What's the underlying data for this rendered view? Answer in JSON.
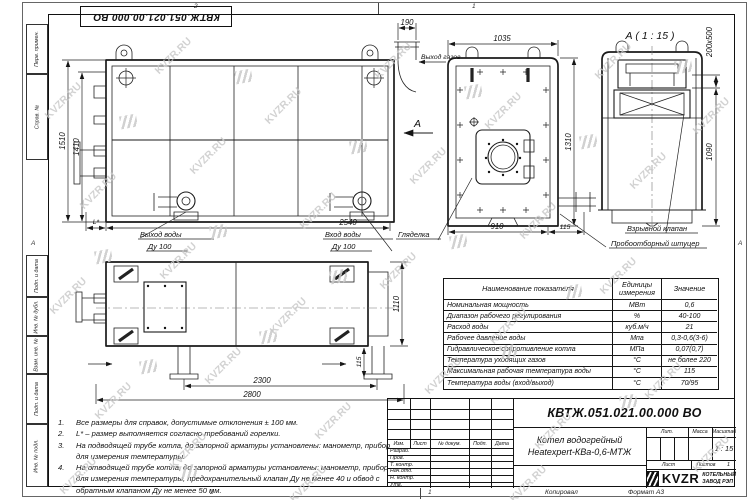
{
  "watermark": {
    "text": "KVZR.RU"
  },
  "frame": {
    "stamp": "КВТЖ.051.021.00.000 ВО",
    "left_labels": [
      "Перв. примен.",
      "Справ. №",
      "Подп. и дата",
      "Инв. № дубл.",
      "Взам. инв. №",
      "Подп. и дата",
      "Инв. № подл."
    ],
    "zone_top_left": "2",
    "zone_top_right": "1",
    "zone_bottom_left": "2",
    "zone_bottom_right": "1",
    "zone_side": "А",
    "copied": "Копировал",
    "format": "Формат А3"
  },
  "front_view": {
    "dim_height_outer": "1510",
    "dim_height_inner": "1410",
    "dim_width": "2540",
    "dim_gas": "190",
    "dim_l": "L*",
    "label_gas_out": "Выход газов",
    "label_water_out_1": "Выход воды",
    "label_water_out_2": "Ду 100",
    "label_water_in_1": "Вход воды",
    "label_water_in_2": "Ду 100",
    "label_sight": "Гляделка",
    "view_arrow": "А"
  },
  "side_view": {
    "dim_width": "1035",
    "dim_height": "1310",
    "dim_bottom": "910",
    "dim_offset": "115"
  },
  "view_a": {
    "title": "А ( 1 : 15 )",
    "dim_size": "200х500",
    "dim_height": "1090",
    "label_explosion": "Взрывной клапан",
    "label_sampling": "Пробоотборный штуцер"
  },
  "plan_view": {
    "dim_legs": "2300",
    "dim_total": "2800",
    "dim_depth": "1110",
    "dim_leg_offset": "115"
  },
  "spec_table": {
    "headers": [
      "Наименование показателя",
      "Единицы измерения",
      "Значение"
    ],
    "rows": [
      [
        "Номинальная мощность",
        "МВт",
        "0,6"
      ],
      [
        "Диапазон рабочего регулирования",
        "%",
        "40-100"
      ],
      [
        "Расход воды",
        "куб.м/ч",
        "21"
      ],
      [
        "Рабочее давление воды",
        "Мпа",
        "0,3-0,6(3-6)"
      ],
      [
        "Гидравлическое сопротивление котла",
        "МПа",
        "0,07(0,7)"
      ],
      [
        "Температура уходящих газов",
        "°С",
        "не более 220"
      ],
      [
        "Максимальная рабочая температура воды",
        "°С",
        "115"
      ],
      [
        "Температура воды (вход/выход)",
        "°С",
        "70/95"
      ]
    ]
  },
  "notes": {
    "items": [
      {
        "n": "1.",
        "t": "Все размеры для справок, допустимые отклонения ± 100 мм."
      },
      {
        "n": "2.",
        "t": "L* – размер выполняется согласно требований горелки."
      },
      {
        "n": "3.",
        "t": "На подводящей трубе котла, до запорной арматуры установлены: манометр, прибор для измерения температуры."
      },
      {
        "n": "4.",
        "t": "На отводящей трубе котла, до запорной арматуры установлены: манометр, прибор для измерения температуры, предохранительный клапан Ду не менее 40 и обвод с обратным клапаном Ду не менее 50 мм."
      }
    ]
  },
  "title_block": {
    "doc_number": "КВТЖ.051.021.00.000 ВО",
    "product_line1": "Котел водогрейный",
    "product_line2": "Heatexpert-КВа-0,6-МТЖ",
    "cols": [
      "Изм.",
      "Лист",
      "№ докум.",
      "Подп.",
      "Дата"
    ],
    "roles": [
      "Разраб.",
      "Пров.",
      "Т. контр.",
      "Нач.отд.",
      "Н. контр.",
      "Утв."
    ],
    "lit": "Лит.",
    "mass": "Масса",
    "scale": "Масштаб",
    "scale_value": "1 : 15",
    "sheet": "Лист",
    "sheets": "Листов",
    "sheets_value": "1",
    "brand": "KVZR",
    "brand_line1": "КОТЕЛЬНЫЙ",
    "brand_line2": "ЗАВОД РЭП"
  }
}
